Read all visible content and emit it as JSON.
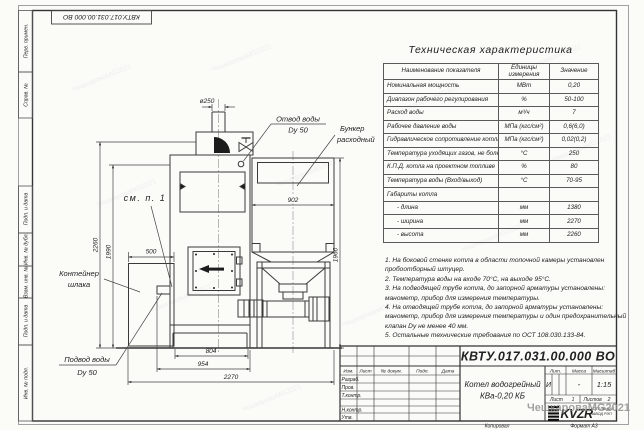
{
  "page": {
    "watermark": "ЧешкароваMG2021",
    "copied_label": "Копировал",
    "format_label": "Формат А3",
    "top_designation": "КВТУ.017.031.00.000 ВО"
  },
  "side_strip": {
    "items": [
      {
        "label": "Перв. примен."
      },
      {
        "label": "Справ. №"
      },
      {
        "label": "Подп. и дата"
      },
      {
        "label": "Инв. № дубл."
      },
      {
        "label": "Взам. инв. №"
      },
      {
        "label": "Подп. и дата"
      },
      {
        "label": "Инв. № подл."
      }
    ]
  },
  "spec_table": {
    "title": "Техническая характеристика",
    "headers": [
      "Наименование показателя",
      "Единицы измерения",
      "Значение"
    ],
    "rows": [
      {
        "name": "Номинальная мощность",
        "unit": "МВт",
        "value": "0,20"
      },
      {
        "name": "Диапазон рабочего регулирования",
        "unit": "%",
        "value": "50-100"
      },
      {
        "name": "Расход воды",
        "unit": "м³/ч",
        "value": "7"
      },
      {
        "name": "Рабочее давление воды",
        "unit": "МПа (кгс/см²)",
        "value": "0,6(6,0)"
      },
      {
        "name": "Гидравлическое сопротивление котла",
        "unit": "МПа (кгс/см²)",
        "value": "0,02(0,2)"
      },
      {
        "name": "Температура уходящих газов, не более",
        "unit": "°С",
        "value": "250"
      },
      {
        "name": "К.П.Д. котла на проектном топливе",
        "unit": "%",
        "value": "80"
      },
      {
        "name": "Температура воды (Вход/выход)",
        "unit": "°С",
        "value": "70-95"
      },
      {
        "name": "Габариты котла",
        "unit": "",
        "value": ""
      },
      {
        "name": "- длина",
        "unit": "мм",
        "value": "1380"
      },
      {
        "name": "- ширина",
        "unit": "мм",
        "value": "2270"
      },
      {
        "name": "- высота",
        "unit": "мм",
        "value": "2260"
      }
    ]
  },
  "notes": {
    "lines": [
      "1. На боковой стенке котла в области топочной камеры установлен",
      "пробоотборный штуцер.",
      "2. Температура воды на входе 70°С, на выходе 95°С.",
      "3. На подводящей трубе котла, до запорной арматуры установлены:",
      "манометр, прибор для измерения температуры.",
      "4. На отводящей трубе котла, до запорной арматуры установлены:",
      "манометр, прибор для измерения температуры и один предохранительный",
      "клапан Dу не менее 40 мм.",
      "5. Остальные технические требования по ОСТ 108.030.133-84."
    ]
  },
  "drawing": {
    "dims": {
      "chimney": "ø250",
      "total_height": "2260",
      "left_height": "1990",
      "bunker_width": "902",
      "bunker_height": "1960",
      "container_offset": "500",
      "plinth_width": "804",
      "body_width": "954",
      "overall_width": "2270"
    },
    "labels": {
      "outlet_1": "Отвод воды",
      "outlet_2": "Dy 50",
      "bunker_1": "Бункер",
      "bunker_2": "расходный",
      "see_note": "см. п. 1",
      "slag_1": "Контейнер",
      "slag_2": "шлака",
      "inlet_1": "Подвод воды",
      "inlet_2": "Dy 50"
    }
  },
  "title_block": {
    "designation": "КВТУ.017.031.00.000  ВО",
    "name_line1": "Котел водогрейный",
    "name_line2": "КВа-0,20  КБ",
    "cols": [
      "Изм.",
      "Лист",
      "№ докум.",
      "Подп.",
      "Дата"
    ],
    "rows": [
      "Разраб.",
      "Пров.",
      "Т.контр.",
      "Н.контр.",
      "Утв."
    ],
    "lit_header": "Лит.",
    "mass_header": "Масса",
    "scale_header": "Масштаб",
    "lit": "И",
    "mass": "-",
    "scale": "1:15",
    "sheet_label": "Лист",
    "sheet_no": "1",
    "sheets_label": "Листов",
    "sheets_no": "2",
    "logo": "KVZR",
    "org_line1": "КОТЕЛЬНЫЙ",
    "org_line2": "ЗАВОД РЭП"
  }
}
